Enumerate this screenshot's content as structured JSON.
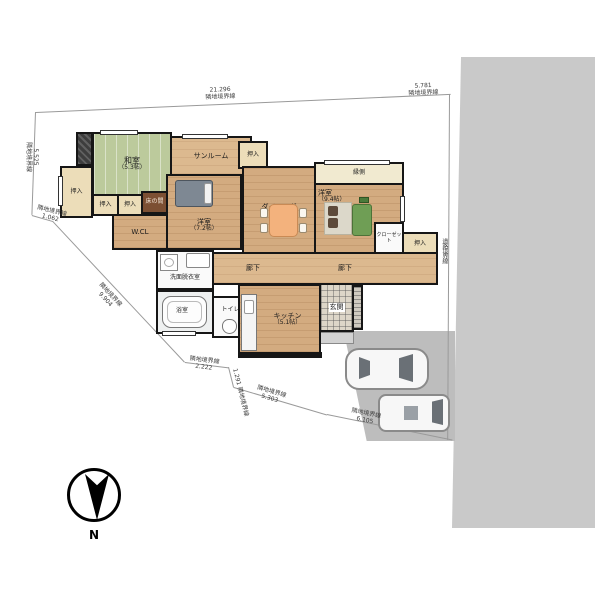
{
  "rooms": {
    "washitsu": {
      "label": "和室",
      "size": "（5.3帖）"
    },
    "sunroom": {
      "label": "サンルーム"
    },
    "oshiire": {
      "label": "押入"
    },
    "tokonoma": {
      "label": "床の間"
    },
    "wcl": {
      "label": "W.CL"
    },
    "youshitsu72": {
      "label": "洋室",
      "size": "（7.2帖）"
    },
    "dining": {
      "label": "ダイニング",
      "size": "（10帖）"
    },
    "engawa": {
      "label": "縁側"
    },
    "youshitsu94": {
      "label": "洋室",
      "size": "（9.4帖）"
    },
    "closet": {
      "label": "クローゼット"
    },
    "rouka": {
      "label": "廊下"
    },
    "senmen": {
      "label": "洗面脱衣室"
    },
    "bath": {
      "label": "浴室"
    },
    "toilet": {
      "label": "トイレ"
    },
    "kitchen": {
      "label": "キッチン",
      "size": "（5.1帖）"
    },
    "hall": {
      "label": "ホール"
    },
    "genkan": {
      "label": "玄関"
    }
  },
  "boundaries": {
    "top": {
      "value": "21.296",
      "label": "隣地境界線"
    },
    "top_right": {
      "value": "5.781",
      "label": "隣地境界線"
    },
    "left": {
      "value": "5.525",
      "label": "隣地境界線"
    },
    "corner": {
      "value": "1.062",
      "label": "隣地境界線"
    },
    "southwest": {
      "value": "9.904",
      "label": "隣地境界線"
    },
    "south1": {
      "value": "2.222",
      "label": "隣地境界線"
    },
    "south2": {
      "value": "1.291",
      "label": "隣地境界線"
    },
    "south3": {
      "value": "5.303",
      "label": "隣地境界線"
    },
    "south4": {
      "value": "6.105",
      "label": "隣地境界線"
    },
    "road": {
      "label": "道路境界線"
    }
  },
  "compass": {
    "label": "N"
  },
  "colors": {
    "tatami": "#bcca9c",
    "wood": "#d3ab80",
    "engawa": "#f1ead0",
    "tokonoma": "#7c4f33",
    "road": "#c9c9c9",
    "parking": "#bdbdbd",
    "sofa": "#6f9e55",
    "dining_table": "#f3b27d",
    "walls": "#161616"
  }
}
